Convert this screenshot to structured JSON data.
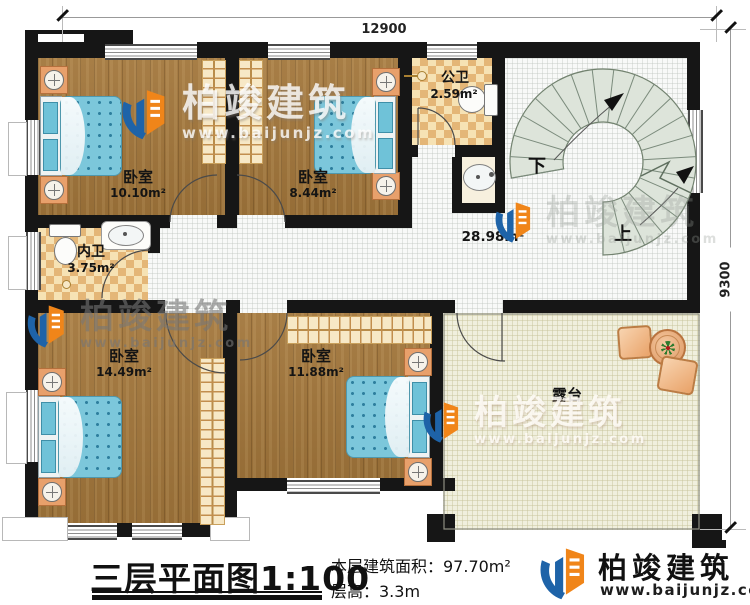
{
  "plan": {
    "dim_top": "12900",
    "dim_right": "9300",
    "rooms": {
      "bedroom1": {
        "name": "卧室",
        "area": "10.10m²"
      },
      "bedroom2": {
        "name": "卧室",
        "area": "8.44m²"
      },
      "public_bath": {
        "name": "公卫",
        "area": "2.59m²"
      },
      "private_bath": {
        "name": "内卫",
        "area": "3.75m²"
      },
      "bedroom3": {
        "name": "卧室",
        "area": "14.49m²"
      },
      "bedroom4": {
        "name": "卧室",
        "area": "11.88m²"
      },
      "hall": {
        "area": "28.98m²"
      },
      "terrace": {
        "name": "露台"
      }
    },
    "stairs": {
      "down": "下",
      "up": "上"
    }
  },
  "footer": {
    "title": "三层平面图1:100",
    "area_line": "本层建筑面积：97.70m²",
    "height_line": "层高：3.3m"
  },
  "brand": {
    "name": "柏竣建筑",
    "url": "www.baijunjz.com"
  },
  "colors": {
    "wall": "#161616",
    "wood": "#a2763b",
    "tile": "#e4b677",
    "mattress": "#7cc7db",
    "stair": "#dde4da",
    "brand_blue": "#1e63a8",
    "brand_orange": "#f08519"
  }
}
